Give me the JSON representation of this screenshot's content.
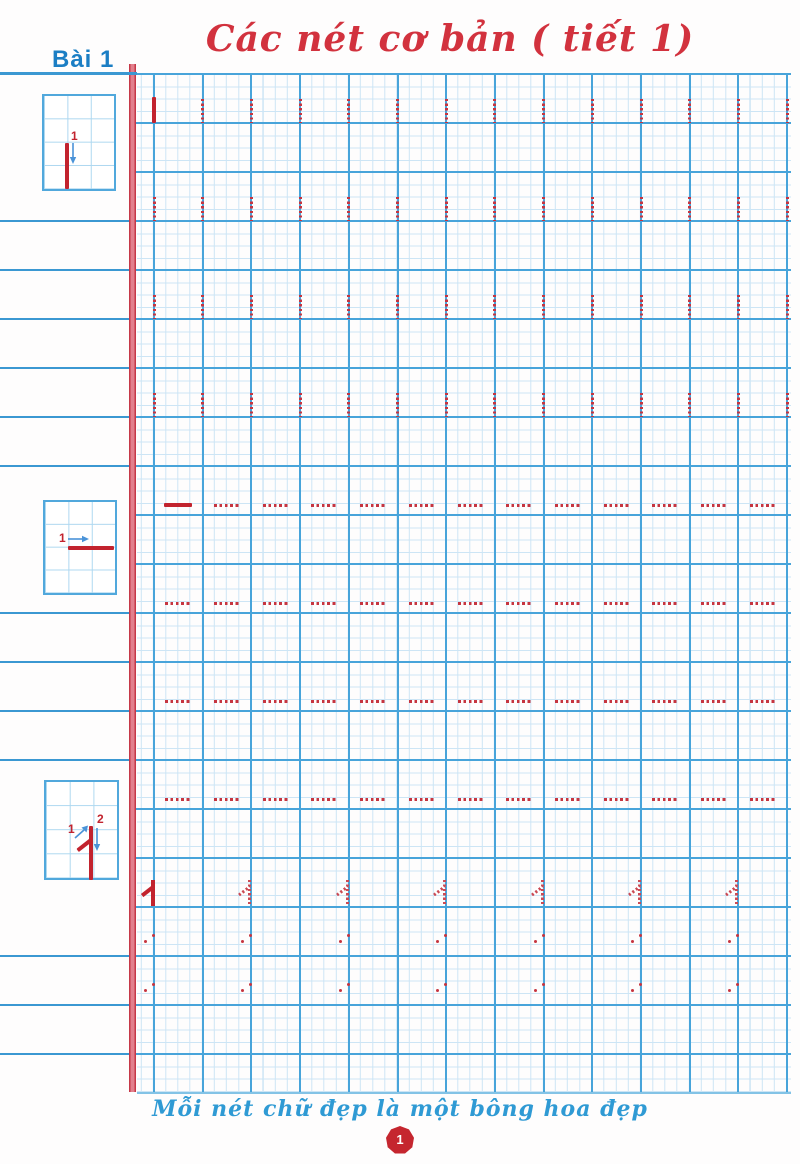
{
  "header": {
    "title": "Các nét cơ bản ( tiết 1)",
    "lesson_label": "Bài 1"
  },
  "footer": {
    "quote": "Mỗi nét chữ đẹp là một bông hoa đẹp",
    "page_number": "1"
  },
  "colors": {
    "title_red": "#d2323e",
    "stroke_red": "#c2232e",
    "grid_heavy_blue": "#48a4da",
    "grid_fine_blue": "#cde5f5",
    "rule_blue": "#3b98d2",
    "lesson_blue": "#1b7ec4",
    "footer_blue": "#2f9ad4",
    "badge_red": "#c5262f",
    "margin_red": "#c63848"
  },
  "grid": {
    "left": 130,
    "top": 74,
    "right": 791,
    "bottom": 1092,
    "col_start": 154,
    "col_step": 48.7,
    "col_count": 14,
    "row_start": 74,
    "row_step": 49,
    "row_count": 21
  },
  "left_strip": {
    "line_rows": [
      3,
      4,
      5,
      6,
      7,
      8,
      11,
      12,
      13,
      14,
      18,
      19,
      20
    ]
  },
  "practice": {
    "vertical_bands": [
      {
        "row": 1,
        "solid_cols": [
          0
        ]
      },
      {
        "row": 3,
        "solid_cols": []
      },
      {
        "row": 5,
        "solid_cols": []
      },
      {
        "row": 7,
        "solid_cols": []
      }
    ],
    "vertical_stroke_height": 24,
    "dash_rows": [
      {
        "row": 9,
        "solid_cells": [
          0
        ]
      },
      {
        "row": 11,
        "solid_cells": []
      },
      {
        "row": 13,
        "solid_cells": []
      },
      {
        "row": 15,
        "solid_cells": []
      }
    ],
    "dash_offset": 10,
    "one_row": {
      "row": 17,
      "cols": [
        0,
        2,
        4,
        6,
        8,
        10,
        12
      ],
      "solid_cols": [
        0
      ]
    },
    "dot_pair_rows": [
      {
        "row": 18
      },
      {
        "row": 19
      }
    ]
  },
  "boxes": [
    {
      "type": "vertical-stroke",
      "step_labels": [
        "1"
      ]
    },
    {
      "type": "horizontal-stroke",
      "step_labels": [
        "1"
      ]
    },
    {
      "type": "numeral-one",
      "step_labels": [
        "1",
        "2"
      ]
    }
  ]
}
